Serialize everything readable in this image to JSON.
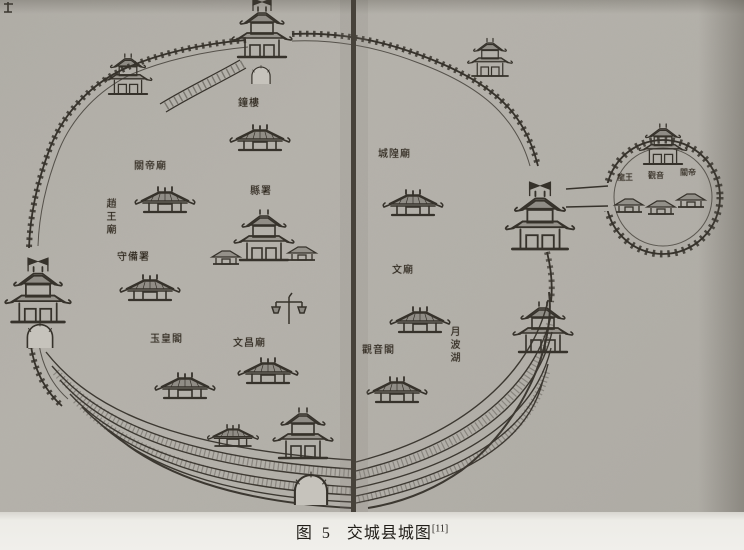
{
  "figure": {
    "caption_prefix": "图 5",
    "caption_title": "交城县城图",
    "caption_ref": "[11]"
  },
  "map": {
    "description_labels_note": "hand-written place labels on the old county map",
    "labels": [
      {
        "text": "鐘樓",
        "orientation": "horizontal"
      },
      {
        "text": "關帝廟",
        "orientation": "horizontal"
      },
      {
        "text": "趙王廟",
        "orientation": "vertical"
      },
      {
        "text": "守備署",
        "orientation": "horizontal"
      },
      {
        "text": "縣署",
        "orientation": "horizontal"
      },
      {
        "text": "文昌廟",
        "orientation": "horizontal"
      },
      {
        "text": "玉皇閣",
        "orientation": "horizontal"
      },
      {
        "text": "城隍廟",
        "orientation": "horizontal"
      },
      {
        "text": "文廟",
        "orientation": "horizontal"
      },
      {
        "text": "月波湖",
        "orientation": "vertical"
      },
      {
        "text": "觀音閣",
        "orientation": "horizontal"
      },
      {
        "text": "龍王",
        "orientation": "horizontal"
      },
      {
        "text": "觀音",
        "orientation": "horizontal"
      },
      {
        "text": "關帝",
        "orientation": "horizontal"
      }
    ]
  },
  "colors": {
    "paper_scan": "#b2afa8",
    "paper_margin": "#eceae5",
    "ink": "#36322b",
    "fold_line": "#47423a"
  }
}
